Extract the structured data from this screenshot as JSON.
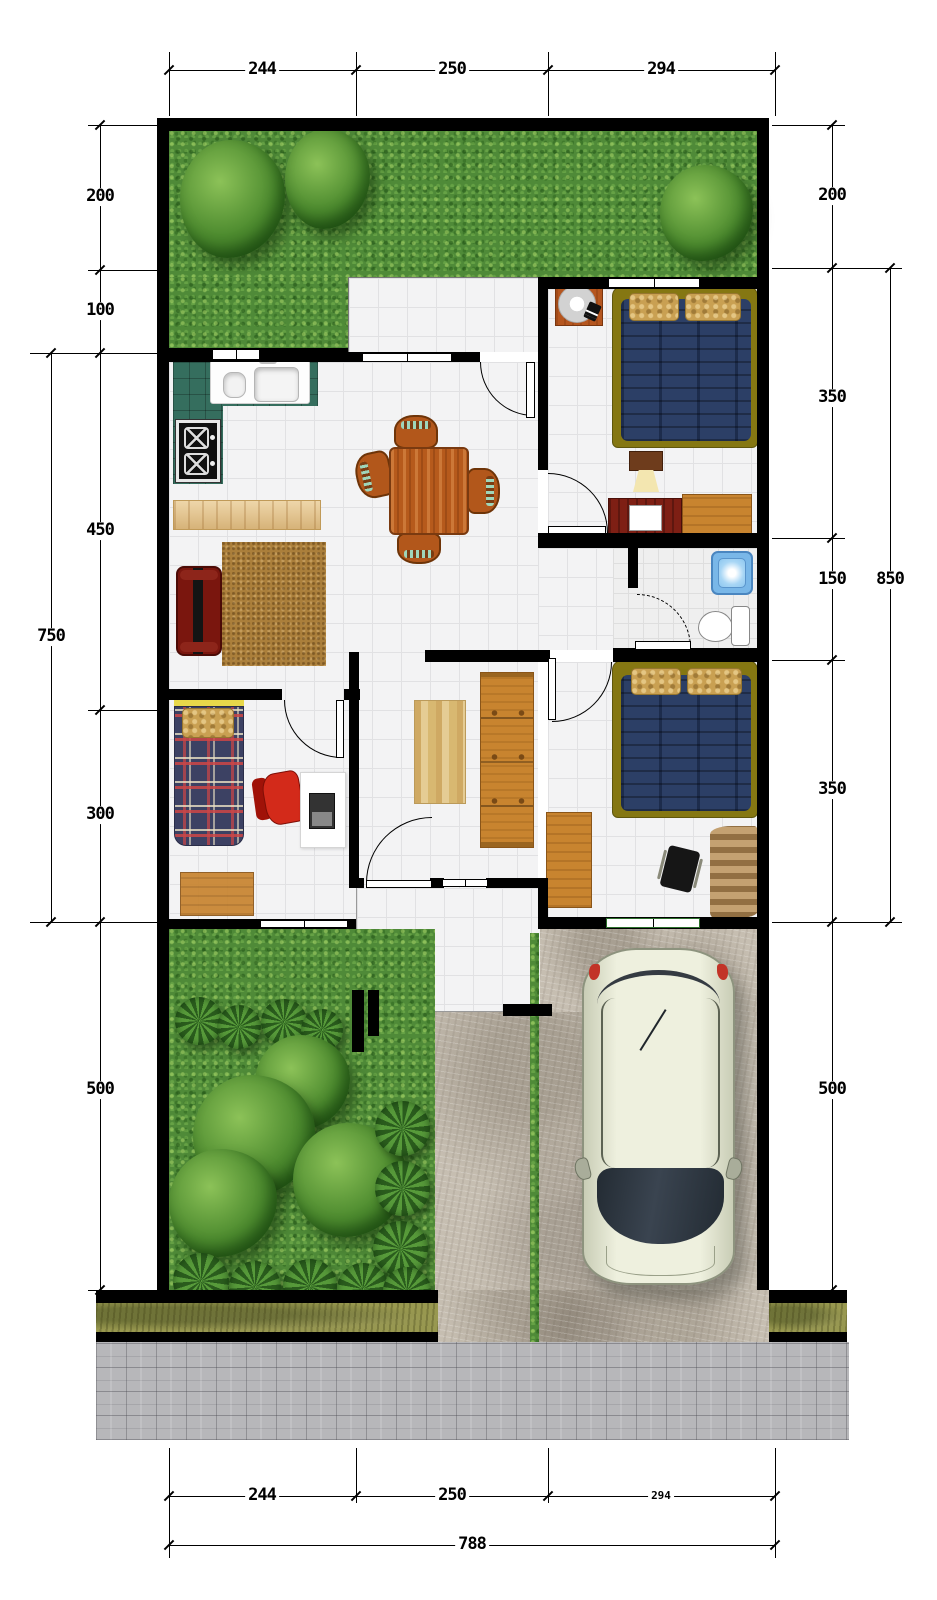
{
  "dimensions": {
    "top": [
      "244",
      "250",
      "294"
    ],
    "left_inner": [
      "200",
      "100",
      "450",
      "300"
    ],
    "left_outer_total": "750",
    "left_front_garden": "500",
    "right_inner": [
      "200",
      "350",
      "150",
      "350"
    ],
    "right_outer_total": "850",
    "right_front_garden": "500",
    "bottom": [
      "244",
      "250",
      "294"
    ],
    "bottom_total": "788"
  },
  "colors": {
    "wall": "#000000",
    "floor_tile": "#f3f3f4",
    "grass": "#4f8a38",
    "concrete_driveway": "#c6beb1",
    "paver_sidewalk": "#b7b7ba",
    "verge_strip": "#98984f",
    "bed_mattress_blue": "#2c3f66",
    "bed_frame_olive": "#857712",
    "pillow_tan": "#c9a052",
    "wood_furniture": "#c8842f",
    "kitchen_counter_green": "#356e5e",
    "sofa_dark_red": "#7a160e",
    "chair_red": "#cf2418",
    "car_body_cream": "#eef0de",
    "shower_blue": "#8cc6ef"
  },
  "fixtures": [
    "double-bed",
    "single-bed",
    "wardrobe",
    "dining-table",
    "kitchen-sink",
    "stove",
    "sideboard",
    "toilet",
    "shower-tray",
    "car",
    "sofa",
    "desk",
    "office-chair",
    "table-fan",
    "bedside-lamp",
    "tv-cabinet",
    "rug",
    "tree",
    "shrub"
  ]
}
